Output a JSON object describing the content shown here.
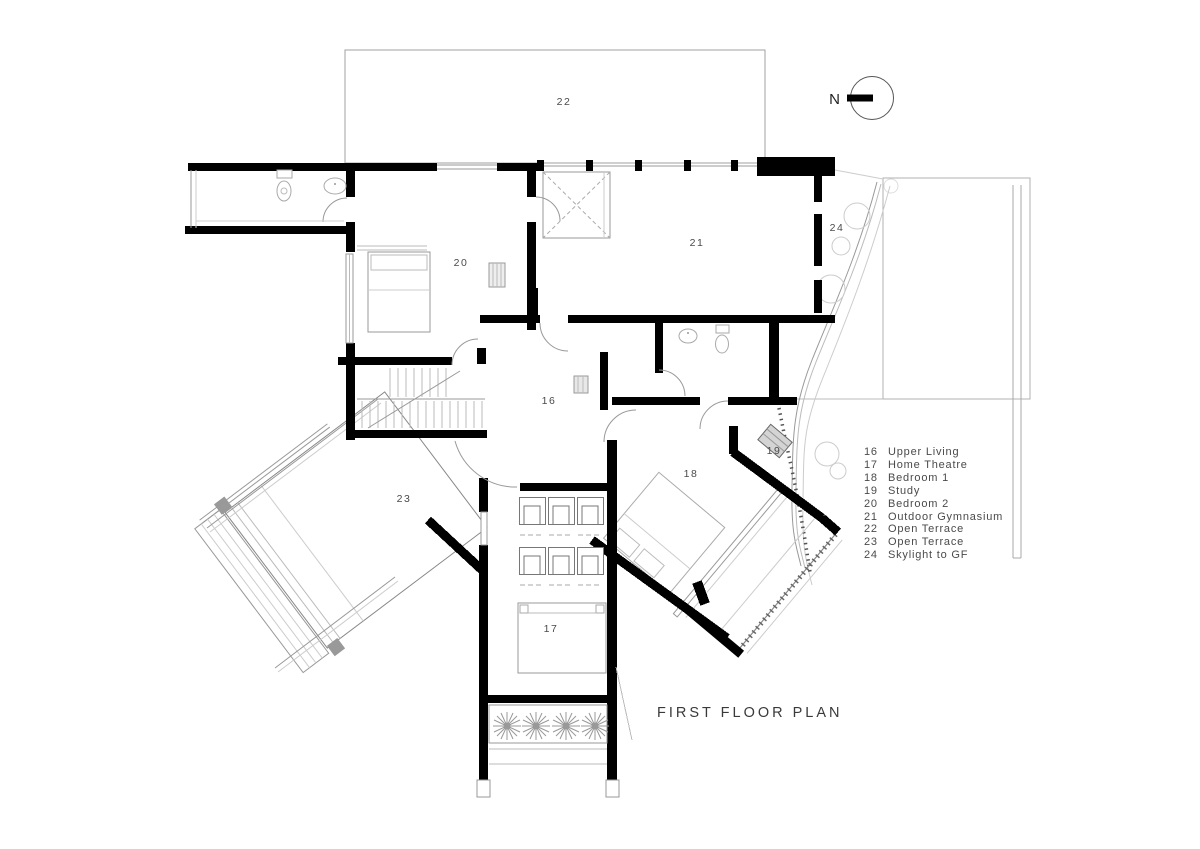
{
  "drawing": {
    "title": "FIRST FLOOR PLAN"
  },
  "north": {
    "label": "N"
  },
  "rooms": {
    "r16": "16",
    "r17": "17",
    "r18": "18",
    "r19": "19",
    "r20": "20",
    "r21": "21",
    "r22": "22",
    "r23": "23",
    "r24": "24"
  },
  "legend": {
    "items": [
      {
        "no": "16",
        "name": "Upper Living"
      },
      {
        "no": "17",
        "name": "Home Theatre"
      },
      {
        "no": "18",
        "name": "Bedroom 1"
      },
      {
        "no": "19",
        "name": "Study"
      },
      {
        "no": "20",
        "name": "Bedroom 2"
      },
      {
        "no": "21",
        "name": "Outdoor Gymnasium"
      },
      {
        "no": "22",
        "name": "Open Terrace"
      },
      {
        "no": "23",
        "name": "Open Terrace"
      },
      {
        "no": "24",
        "name": "Skylight to GF"
      }
    ]
  },
  "colors": {
    "wall": "#000000",
    "line": "#999999",
    "text": "#4a4a4a"
  }
}
